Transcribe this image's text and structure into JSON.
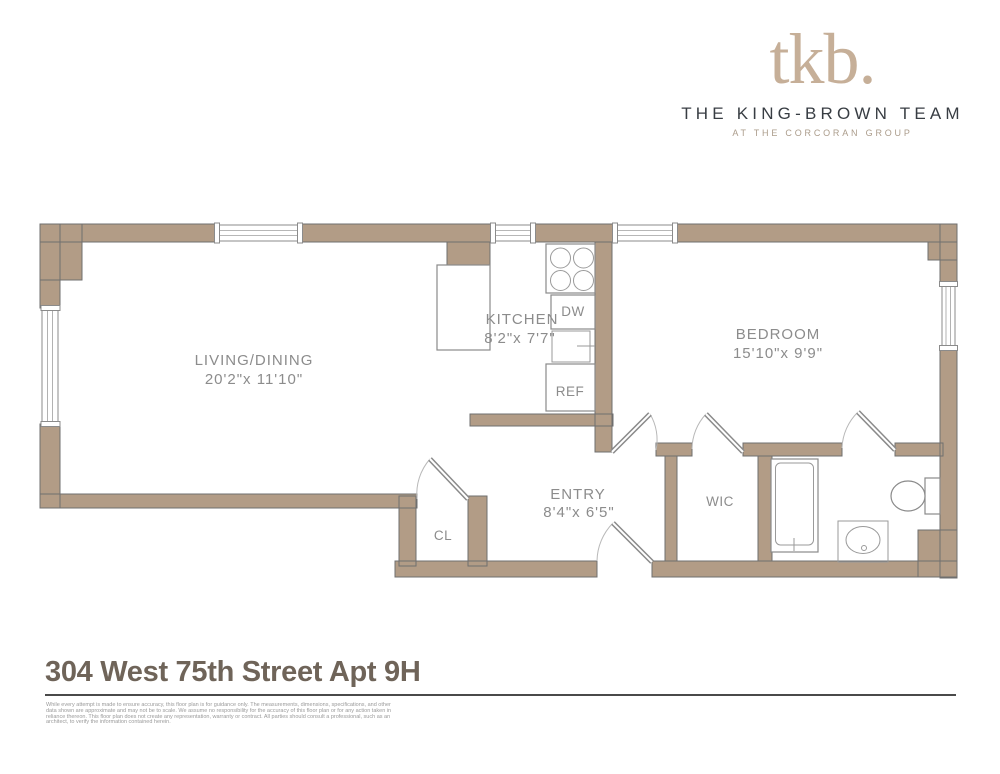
{
  "header": {
    "logo": "tkb.",
    "team_name": "THE KING-BROWN TEAM",
    "tagline": "AT THE CORCORAN GROUP"
  },
  "plan": {
    "living": {
      "name": "LIVING/DINING",
      "dims": "20'2\"x 11'10\""
    },
    "kitchen": {
      "name": "KITCHEN",
      "dims": "8'2\"x 7'7\""
    },
    "bedroom": {
      "name": "BEDROOM",
      "dims": "15'10\"x 9'9\""
    },
    "entry": {
      "name": "ENTRY",
      "dims": "8'4\"x 6'5\""
    },
    "wic": {
      "label": "WIC"
    },
    "closet": {
      "label": "CL"
    },
    "dishwasher": {
      "label": "DW"
    },
    "refrigerator": {
      "label": "REF"
    },
    "fixtures": [
      "stove-burners",
      "dishwasher",
      "kitchen-sink",
      "refrigerator",
      "kitchen-counter",
      "bathtub",
      "vanity-sink",
      "toilet"
    ],
    "windows": 5,
    "doors": 5
  },
  "footer": {
    "address": "304 West 75th Street Apt 9H",
    "disclaimer_lines": [
      "While every attempt is made to ensure accuracy, this floor plan is for guidance only. The measurements, dimensions, specifications, and other",
      "data shown are approximate and may not be to scale. We assume no responsibility for the accuracy of this floor plan or for any action taken in",
      "reliance thereon. This floor plan does not create any representation, warranty or contract. All parties should consult a professional, such as an",
      "architect, to verify the information contained herein."
    ]
  },
  "colors": {
    "wall": "#b29c86",
    "plan_label": "#8c8c8c",
    "logo_tan": "#c6af98",
    "team_dark": "#383d43",
    "tagline_tan": "#ab9c8b",
    "address_brown": "#6f6459"
  }
}
